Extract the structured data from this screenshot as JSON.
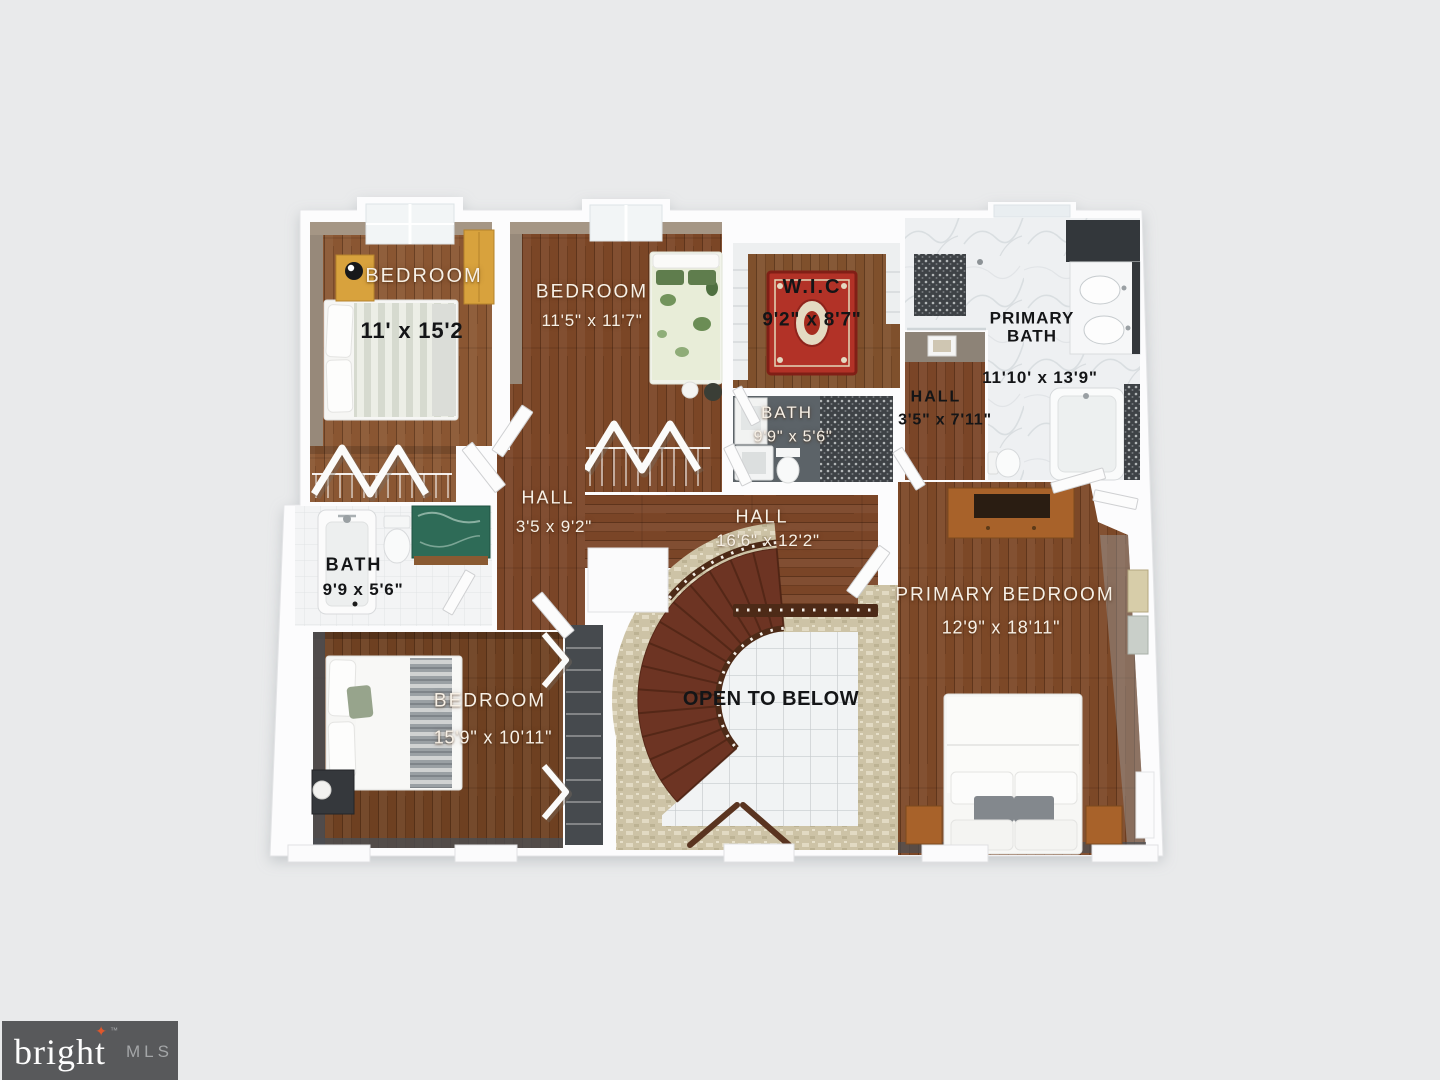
{
  "branding": {
    "name": "bright",
    "trademark": "™",
    "suffix": "MLS"
  },
  "palette": {
    "background": "#e9eaeb",
    "wall_white": "#fcfcfd",
    "wood_floor": "#7b4827",
    "stair_tread": "#6d3423",
    "travertine": "#cfc5a9",
    "rug_red": "#b23227",
    "logo_background": "#58595b",
    "logo_star_orange": "#e0572b"
  },
  "labels": {
    "bedroom1": {
      "name": "BEDROOM",
      "dims": "11' x 15'2"
    },
    "bedroom2": {
      "name": "BEDROOM",
      "dims": "11'5\" x 11'7\""
    },
    "wic": {
      "name": "W.I.C",
      "dims": "9'2\" x 8'7\""
    },
    "primary_bath": {
      "name": "PRIMARY BATH",
      "dims": "11'10' x 13'9\""
    },
    "hall_upper": {
      "name": "HALL",
      "dims": "3'5\" x 7'11\""
    },
    "bath_middle": {
      "name": "BATH",
      "dims": "9'9\" x 5'6\""
    },
    "hall_west": {
      "name": "HALL",
      "dims": "3'5 x 9'2\""
    },
    "hall_main": {
      "name": "HALL",
      "dims": "16'6\" x 12'2\""
    },
    "bath_west": {
      "name": "BATH",
      "dims": "9'9 x 5'6\""
    },
    "bedroom3": {
      "name": "BEDROOM",
      "dims": "15'9\" x 10'11\""
    },
    "open_below": {
      "name": "OPEN TO BELOW"
    },
    "primary_bedroom": {
      "name": "PRIMARY BEDROOM",
      "dims": "12'9\" x 18'11\""
    }
  }
}
